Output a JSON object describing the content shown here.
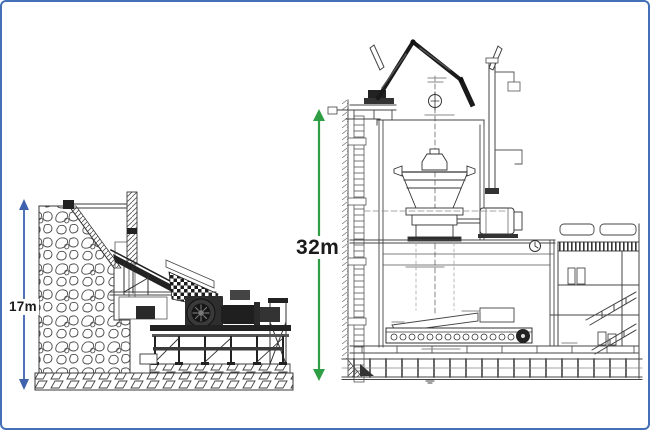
{
  "figure": {
    "type": "technical-drawing-height-comparison",
    "background": "#ffffff",
    "border_color": "#4470b8",
    "left_station": {
      "height_label": "17m",
      "arrow_color": "#3f62ae"
    },
    "right_station": {
      "height_label": "32m",
      "arrow_color": "#2f9e44"
    }
  }
}
